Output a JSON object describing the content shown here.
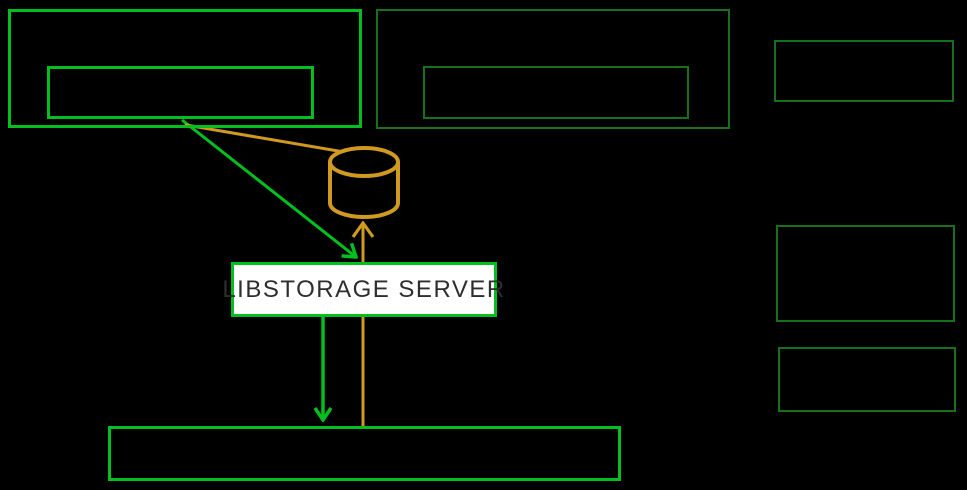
{
  "diagram": {
    "server": {
      "label": "LIBSTORAGE SERVER"
    },
    "nodes": {
      "host_group_left": {
        "label": "",
        "style": "bright-green-outline",
        "children": 1
      },
      "host_group_right": {
        "label": "",
        "style": "dark-green-outline",
        "children": 1
      },
      "side_box_top": {
        "label": "",
        "style": "dark-green-outline"
      },
      "side_box_middle": {
        "label": "",
        "style": "dark-green-outline"
      },
      "side_box_bottom": {
        "label": "",
        "style": "dark-green-outline"
      },
      "bottom_bar": {
        "label": "",
        "style": "bright-green-outline"
      }
    },
    "icons": {
      "database": "database-cylinder-icon"
    },
    "colors": {
      "background": "#000000",
      "bright_green": "#00bf1f",
      "dark_green": "#17701c",
      "orange": "#d09a20",
      "server_fill": "#ffffff",
      "server_text": "#2e2e2e"
    },
    "edges": [
      {
        "from": "host_group_left.inner",
        "to": "server",
        "color": "green",
        "arrow": "end"
      },
      {
        "from": "host_group_left.inner",
        "to": "database",
        "color": "orange",
        "arrow": "none"
      },
      {
        "from": "server",
        "to": "bottom_bar",
        "color": "green",
        "arrow": "end"
      },
      {
        "from": "bottom_bar",
        "to": "database",
        "color": "orange",
        "arrow": "end"
      }
    ]
  }
}
